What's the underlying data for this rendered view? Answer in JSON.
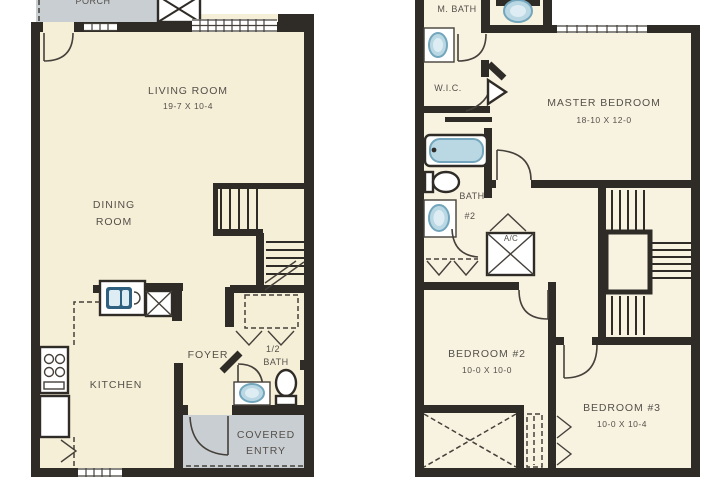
{
  "colors": {
    "background": "#ffffff",
    "floor_fill": "#f5efd8",
    "floor_fill_right": "#f8f3e1",
    "wall": "#2f2b26",
    "porch_gray": "#c9ced2",
    "fixture_blue": "#b9d8e4",
    "fixture_blue_stroke": "#73a6bd",
    "kitchen_sink_blue": "#30607f",
    "label_text": "#55504a"
  },
  "floor1": {
    "porch": {
      "label": "PORCH"
    },
    "living_room": {
      "name": "LIVING ROOM",
      "dims": "19-7 X 10-4"
    },
    "dining_room": {
      "line1": "DINING",
      "line2": "ROOM"
    },
    "kitchen": {
      "label": "KITCHEN"
    },
    "foyer": {
      "label": "FOYER"
    },
    "half_bath": {
      "line1": "1/2",
      "line2": "BATH"
    },
    "covered_entry": {
      "line1": "COVERED",
      "line2": "ENTRY"
    }
  },
  "floor2": {
    "master_bath": {
      "label": "M. BATH"
    },
    "wic": {
      "label": "W.I.C."
    },
    "master_bedroom": {
      "name": "MASTER BEDROOM",
      "dims": "18-10 X 12-0"
    },
    "bath_2": {
      "line1": "BATH",
      "line2": "#2"
    },
    "ac_closet": {
      "label": "A/C"
    },
    "bedroom_2": {
      "name": "BEDROOM #2",
      "dims": "10-0 X 10-0"
    },
    "bedroom_3": {
      "name": "BEDROOM #3",
      "dims": "10-0 X 10-4"
    }
  }
}
